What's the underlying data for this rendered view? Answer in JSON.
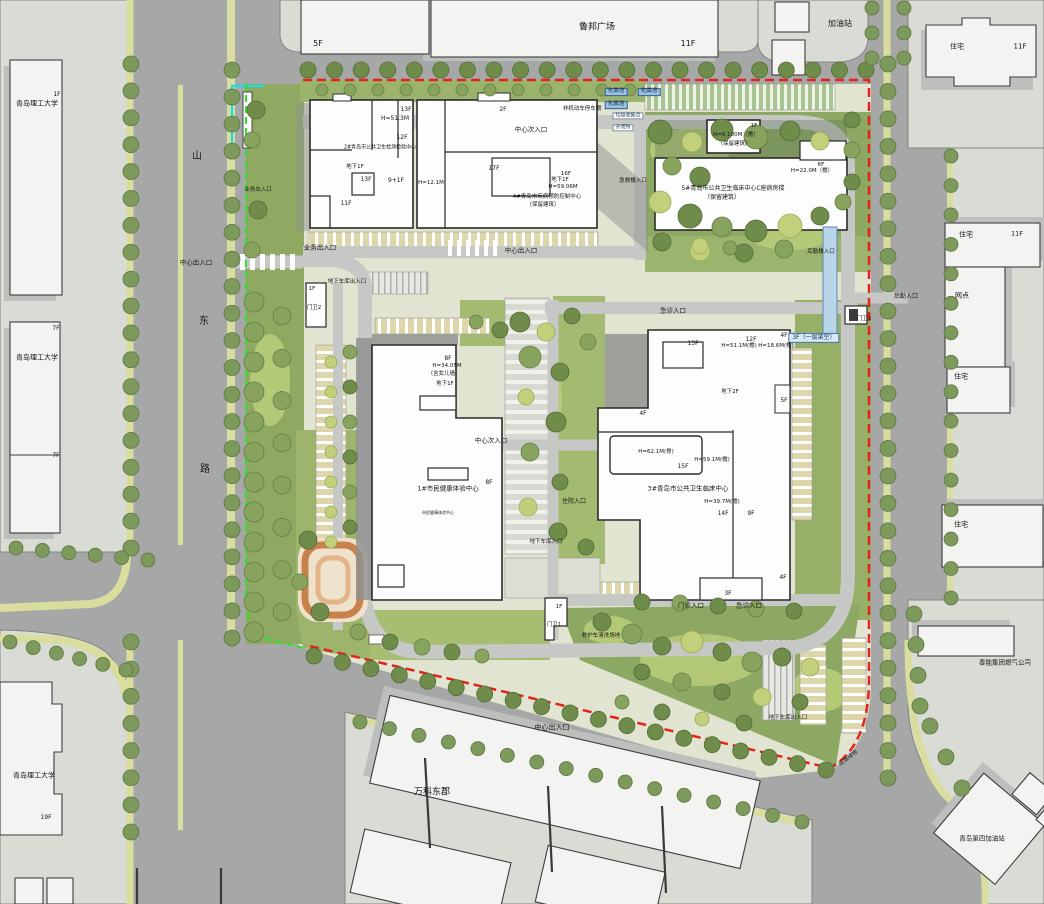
{
  "map_title": "青岛市公共卫生中心总平面图",
  "boundary_colors": {
    "site_red": "#e4231a",
    "property_green": "#2ce32c",
    "cyan_line": "#19dee2",
    "road_gray": "#a6a8a7",
    "parcel_gray": "#d9dbd5",
    "green_main": "#94ad66"
  },
  "street": {
    "name_chars": [
      "山",
      "东",
      "路"
    ]
  },
  "annotations": [
    {
      "t": "鲁邦广场",
      "x": 597,
      "y": 28,
      "s": 9,
      "n": "lubang-plaza-label"
    },
    {
      "t": "5F",
      "x": 318,
      "y": 44,
      "s": 8
    },
    {
      "t": "11F",
      "x": 688,
      "y": 44,
      "s": 8
    },
    {
      "t": "加油站",
      "x": 840,
      "y": 24,
      "s": 8,
      "n": "gas-station-label"
    },
    {
      "t": "住宅",
      "x": 957,
      "y": 47,
      "s": 7
    },
    {
      "t": "11F",
      "x": 1020,
      "y": 47,
      "s": 7
    },
    {
      "t": "青岛理工大学",
      "x": 37,
      "y": 104,
      "s": 7,
      "n": "university-label"
    },
    {
      "t": "1F",
      "x": 57,
      "y": 95,
      "s": 6
    },
    {
      "t": "山",
      "x": 197,
      "y": 157,
      "s": 10,
      "n": "street-char"
    },
    {
      "t": "东",
      "x": 204,
      "y": 322,
      "s": 10,
      "n": "street-char"
    },
    {
      "t": "路",
      "x": 205,
      "y": 470,
      "s": 10,
      "n": "street-char"
    },
    {
      "t": "中心出入口",
      "x": 196,
      "y": 263,
      "s": 6.5,
      "n": "entrance-label"
    },
    {
      "t": "青岛理工大学",
      "x": 37,
      "y": 358,
      "s": 7,
      "n": "university-label"
    },
    {
      "t": "7F",
      "x": 56,
      "y": 329,
      "s": 6
    },
    {
      "t": "7F",
      "x": 56,
      "y": 456,
      "s": 6
    },
    {
      "t": "青岛理工大学",
      "x": 34,
      "y": 776,
      "s": 7,
      "n": "university-label"
    },
    {
      "t": "19F",
      "x": 46,
      "y": 818,
      "s": 6
    },
    {
      "t": "万科东郡",
      "x": 432,
      "y": 793,
      "s": 9,
      "n": "vanke-label"
    },
    {
      "t": "中心出入口",
      "x": 552,
      "y": 728,
      "s": 7,
      "n": "entrance-label"
    },
    {
      "t": "泰能集团燃气公司",
      "x": 1005,
      "y": 663,
      "s": 6.5,
      "n": "gas-company-label"
    },
    {
      "t": "青岛第四加油站",
      "x": 982,
      "y": 839,
      "s": 6.5,
      "n": "gas-station4-label"
    },
    {
      "t": "住宅",
      "x": 966,
      "y": 235,
      "s": 7
    },
    {
      "t": "11F",
      "x": 1017,
      "y": 234,
      "s": 6.5
    },
    {
      "t": "网点",
      "x": 962,
      "y": 296,
      "s": 7
    },
    {
      "t": "住宅",
      "x": 961,
      "y": 377,
      "s": 7
    },
    {
      "t": "住宅",
      "x": 961,
      "y": 525,
      "s": 7
    },
    {
      "t": "后勤入口",
      "x": 906,
      "y": 297,
      "s": 6,
      "n": "entrance-label"
    },
    {
      "t": "化粪池",
      "x": 616,
      "y": 92,
      "s": 5.5,
      "c": "box"
    },
    {
      "t": "化粪池",
      "x": 649,
      "y": 92,
      "s": 5.5,
      "c": "box"
    },
    {
      "t": "化粪池",
      "x": 616,
      "y": 105,
      "s": 5.5,
      "c": "box"
    },
    {
      "t": "非机动车停车棚",
      "x": 582,
      "y": 110,
      "s": 5.5
    },
    {
      "t": "垃圾收集点",
      "x": 628,
      "y": 116,
      "s": 5,
      "c": "wbox"
    },
    {
      "t": "开闭所",
      "x": 623,
      "y": 128,
      "s": 5,
      "c": "wbox"
    },
    {
      "t": "13F",
      "x": 406,
      "y": 110,
      "s": 6
    },
    {
      "t": "H=51.3M",
      "x": 395,
      "y": 119,
      "s": 6
    },
    {
      "t": "12F",
      "x": 402,
      "y": 138,
      "s": 6
    },
    {
      "t": "2#青岛市公共卫生检测检验中心",
      "x": 380,
      "y": 148,
      "s": 5,
      "n": "building2-label"
    },
    {
      "t": "地下1F",
      "x": 355,
      "y": 168,
      "s": 5.5
    },
    {
      "t": "13F",
      "x": 366,
      "y": 180,
      "s": 6
    },
    {
      "t": "9+1F",
      "x": 396,
      "y": 181,
      "s": 6
    },
    {
      "t": "11F",
      "x": 346,
      "y": 204,
      "s": 6
    },
    {
      "t": "2F",
      "x": 503,
      "y": 110,
      "s": 6
    },
    {
      "t": "17F",
      "x": 494,
      "y": 169,
      "s": 6
    },
    {
      "t": "16F",
      "x": 566,
      "y": 175,
      "s": 5.5
    },
    {
      "t": "地下1F",
      "x": 560,
      "y": 181,
      "s": 5.5
    },
    {
      "t": "H=59.06M",
      "x": 563,
      "y": 188,
      "s": 5.5
    },
    {
      "t": "H=12.1M",
      "x": 431,
      "y": 184,
      "s": 5.5
    },
    {
      "t": "4#青岛市疾病预防控制中心",
      "x": 547,
      "y": 198,
      "s": 5.5,
      "n": "building4-label"
    },
    {
      "t": "（保留建筑）",
      "x": 543,
      "y": 206,
      "s": 5.5
    },
    {
      "t": "业务出入口",
      "x": 320,
      "y": 248,
      "s": 6.5,
      "n": "entrance-label"
    },
    {
      "t": "中心出入口",
      "x": 521,
      "y": 251,
      "s": 6.5,
      "n": "entrance-label"
    },
    {
      "t": "中心次入口",
      "x": 531,
      "y": 130,
      "s": 6.5,
      "n": "entrance-label"
    },
    {
      "t": "业务出入口",
      "x": 258,
      "y": 191,
      "s": 5.5,
      "n": "entrance-label"
    },
    {
      "t": "1F",
      "x": 754,
      "y": 127,
      "s": 5.5
    },
    {
      "t": "H=6.100M（檐）",
      "x": 736,
      "y": 136,
      "s": 5.5
    },
    {
      "t": "（保留建筑）",
      "x": 734,
      "y": 145,
      "s": 5.5
    },
    {
      "t": "5#青岛市公共卫生临床中心C座病房楼",
      "x": 733,
      "y": 189,
      "s": 6,
      "n": "building5-label"
    },
    {
      "t": "（保留建筑）",
      "x": 722,
      "y": 198,
      "s": 6
    },
    {
      "t": "6F",
      "x": 821,
      "y": 166,
      "s": 5.5
    },
    {
      "t": "H=22.0M（檐）",
      "x": 812,
      "y": 172,
      "s": 5.5
    },
    {
      "t": "急救楼入口",
      "x": 633,
      "y": 182,
      "s": 5.5,
      "n": "entrance-label"
    },
    {
      "t": "后勤楼入口",
      "x": 821,
      "y": 253,
      "s": 5.5,
      "n": "entrance-label"
    },
    {
      "t": "地下车库出入口",
      "x": 347,
      "y": 283,
      "s": 5.5,
      "n": "entrance-label"
    },
    {
      "t": "1F",
      "x": 312,
      "y": 290,
      "s": 5.5
    },
    {
      "t": "门卫2",
      "x": 314,
      "y": 309,
      "s": 5.5,
      "n": "gatehouse2-label"
    },
    {
      "t": "急诊入口",
      "x": 673,
      "y": 311,
      "s": 6.5,
      "n": "entrance-label"
    },
    {
      "t": "3F（一层架空）",
      "x": 814,
      "y": 338,
      "s": 6,
      "c": "bluebox",
      "n": "skybridge-label"
    },
    {
      "t": "门卫3",
      "x": 864,
      "y": 320,
      "s": 5.5,
      "n": "gatehouse3-label"
    },
    {
      "t": "8F",
      "x": 448,
      "y": 359,
      "s": 6
    },
    {
      "t": "H=34.05M",
      "x": 447,
      "y": 367,
      "s": 5.5
    },
    {
      "t": "（含女儿墙）",
      "x": 444,
      "y": 375,
      "s": 5.5
    },
    {
      "t": "地下1F",
      "x": 445,
      "y": 385,
      "s": 5.5
    },
    {
      "t": "中心次入口",
      "x": 491,
      "y": 441,
      "s": 6.5,
      "n": "entrance-label"
    },
    {
      "t": "8F",
      "x": 489,
      "y": 483,
      "s": 6
    },
    {
      "t": "1#市民健康体验中心",
      "x": 448,
      "y": 489,
      "s": 6.5,
      "n": "building1-label"
    },
    {
      "t": "市民健康体验中心",
      "x": 438,
      "y": 513,
      "s": 4
    },
    {
      "t": "13F",
      "x": 693,
      "y": 344,
      "s": 6
    },
    {
      "t": "12F",
      "x": 751,
      "y": 340,
      "s": 6
    },
    {
      "t": "H=51.1M(檐)",
      "x": 739,
      "y": 347,
      "s": 5.5
    },
    {
      "t": "H=18.6M(檐)",
      "x": 776,
      "y": 347,
      "s": 5.5
    },
    {
      "t": "4F",
      "x": 784,
      "y": 336,
      "s": 6
    },
    {
      "t": "地下2F",
      "x": 730,
      "y": 393,
      "s": 5.5
    },
    {
      "t": "5F",
      "x": 784,
      "y": 401,
      "s": 6
    },
    {
      "t": "4F",
      "x": 643,
      "y": 414,
      "s": 6
    },
    {
      "t": "H=62.1M(脊)",
      "x": 656,
      "y": 453,
      "s": 5.5
    },
    {
      "t": "H=59.1M(檐)",
      "x": 712,
      "y": 461,
      "s": 5.5
    },
    {
      "t": "15F",
      "x": 683,
      "y": 467,
      "s": 6
    },
    {
      "t": "3#青岛市公共卫生临床中心",
      "x": 688,
      "y": 489,
      "s": 6.5,
      "n": "building3-label"
    },
    {
      "t": "H=39.7M(檐)",
      "x": 722,
      "y": 503,
      "s": 5.5
    },
    {
      "t": "14F",
      "x": 723,
      "y": 514,
      "s": 6
    },
    {
      "t": "9F",
      "x": 751,
      "y": 514,
      "s": 6
    },
    {
      "t": "住院入口",
      "x": 574,
      "y": 502,
      "s": 6,
      "n": "entrance-label"
    },
    {
      "t": "地下车库入口",
      "x": 546,
      "y": 543,
      "s": 5.5,
      "n": "entrance-label"
    },
    {
      "t": "4F",
      "x": 783,
      "y": 578,
      "s": 6
    },
    {
      "t": "3F",
      "x": 728,
      "y": 594,
      "s": 6
    },
    {
      "t": "门诊入口",
      "x": 691,
      "y": 606,
      "s": 6.5,
      "n": "entrance-label"
    },
    {
      "t": "急诊入口",
      "x": 749,
      "y": 606,
      "s": 6.5,
      "n": "entrance-label"
    },
    {
      "t": "1F",
      "x": 559,
      "y": 608,
      "s": 5.5
    },
    {
      "t": "门卫1",
      "x": 554,
      "y": 626,
      "s": 5.5,
      "n": "gatehouse1-label"
    },
    {
      "t": "救护车清洗场地",
      "x": 601,
      "y": 637,
      "s": 5.5
    },
    {
      "t": "地下车库出入口",
      "x": 788,
      "y": 719,
      "s": 5.5,
      "n": "entrance-label"
    },
    {
      "t": "街角绿地",
      "x": 849,
      "y": 759,
      "s": 5.5,
      "r": -38
    }
  ]
}
